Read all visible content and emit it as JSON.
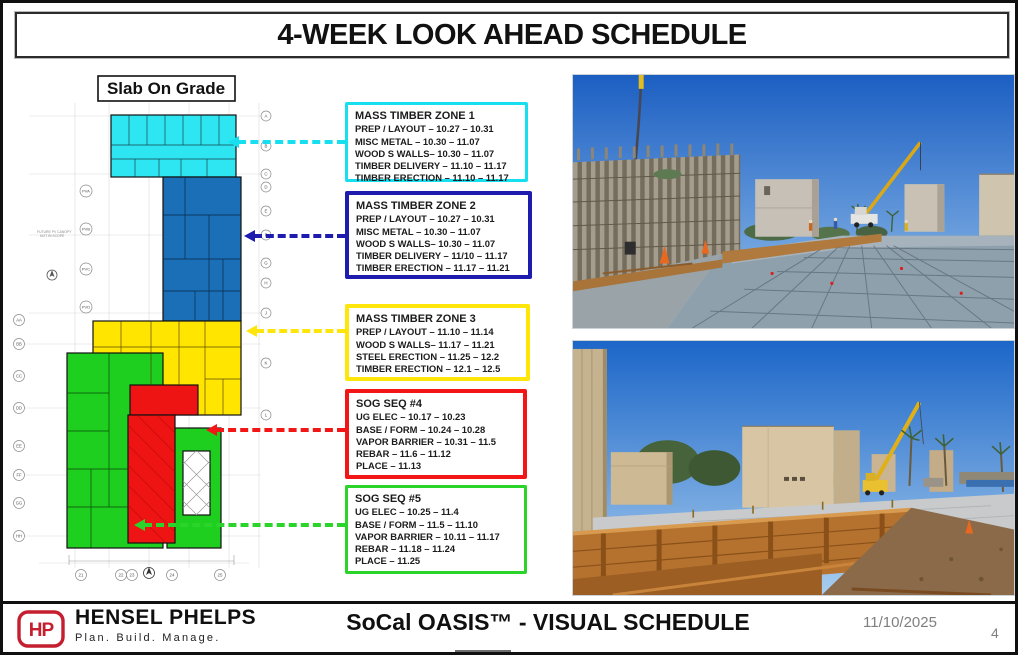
{
  "header": {
    "title": "4-WEEK LOOK AHEAD SCHEDULE"
  },
  "plan": {
    "label": "Slab On Grade",
    "note_line1": "FUTURE PV CANOPY",
    "note_line2": "NOT IN SCOPE",
    "zone_fills": {
      "zone1": "#2de6f2",
      "zone2": "#1a6fb6",
      "zone3": "#ffe500",
      "sog4": "#ee1414",
      "sog5": "#1fcf1f"
    },
    "grid_right": [
      "A",
      "B",
      "C",
      "D",
      "E",
      "F",
      "G",
      "H",
      "J",
      "K",
      "L"
    ],
    "grid_pv": [
      "PVA",
      "PVB",
      "PVC",
      "PVD"
    ],
    "grid_left": [
      "AA",
      "BB",
      "CC",
      "DD",
      "EE",
      "FF",
      "GG",
      "HH"
    ],
    "grid_bottom": [
      "21",
      "22",
      "23",
      "24",
      "25"
    ]
  },
  "callouts": [
    {
      "title": "MASS TIMBER ZONE 1",
      "color": "#17dff0",
      "lines": [
        "PREP / LAYOUT – 10.27 – 10.31",
        "MISC METAL – 10.30 – 11.07",
        "WOOD S WALLS– 10.30 – 11.07",
        "TIMBER DELIVERY – 11.10 – 11.17",
        "TIMBER ERECTION – 11.10 – 11.17"
      ]
    },
    {
      "title": "MASS TIMBER ZONE 2",
      "color": "#1d1caf",
      "lines": [
        "PREP / LAYOUT – 10.27 – 10.31",
        "MISC METAL – 10.30 – 11.07",
        "WOOD S WALLS– 10.30 – 11.07",
        "TIMBER DELIVERY – 11/10 – 11.17",
        "TIMBER ERECTION – 11.17 – 11.21"
      ]
    },
    {
      "title": "MASS TIMBER ZONE 3",
      "color": "#ffe60a",
      "lines": [
        "PREP / LAYOUT – 11.10 – 11.14",
        "WOOD S WALLS– 11.17 – 11.21",
        "STEEL ERECTION – 11.25 – 12.2",
        "TIMBER ERECTION – 12.1 – 12.5"
      ]
    },
    {
      "title": "SOG SEQ #4",
      "color": "#f31616",
      "lines": [
        "UG ELEC – 10.17 – 10.23",
        "BASE / FORM – 10.24 – 10.28",
        "VAPOR BARRIER – 10.31 – 11.5",
        "REBAR – 11.6 – 11.12",
        "PLACE – 11.13"
      ]
    },
    {
      "title": "SOG SEQ #5",
      "color": "#2ad42a",
      "lines": [
        "UG ELEC – 10.25 – 11.4",
        "BASE / FORM – 11.5 – 11.10",
        "VAPOR BARRIER – 10.11 – 11.17",
        "REBAR – 11.18 – 11.24",
        "PLACE – 11.25"
      ]
    }
  ],
  "footer": {
    "logo_text": "HP",
    "brand_red": "#c41e2f",
    "company": "HENSEL PHELPS",
    "tagline": "Plan. Build. Manage.",
    "slide_title": "SoCal OASIS™ - VISUAL SCHEDULE",
    "date": "11/10/2025",
    "page": "4"
  }
}
